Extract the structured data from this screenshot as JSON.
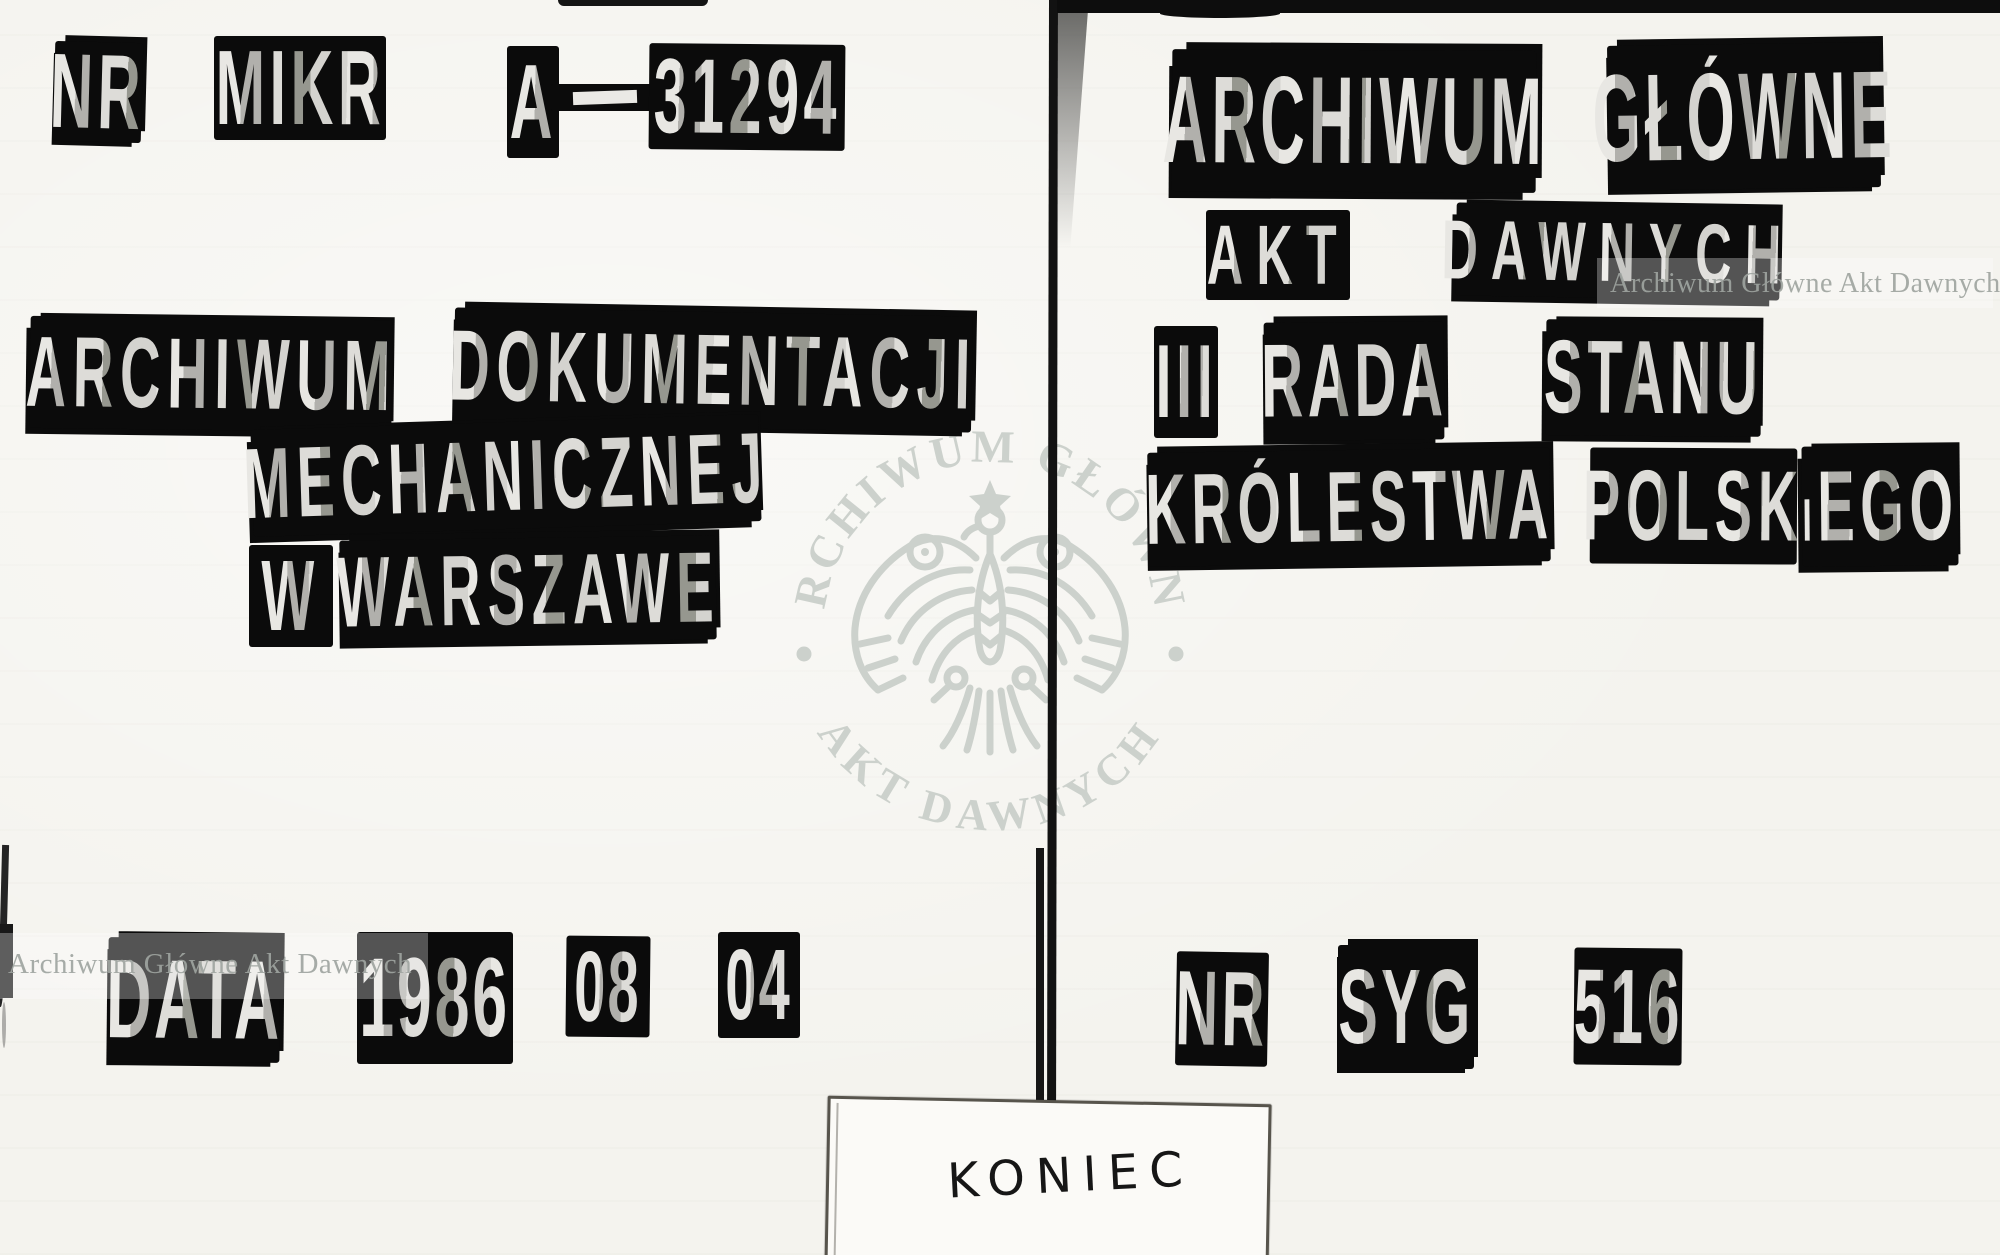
{
  "left_page": {
    "microfilm_row": {
      "nr": "NR",
      "mikr": "MIKR",
      "series": "A",
      "number": "31294"
    },
    "institution": {
      "line1_word1": "ARCHIWUM",
      "line1_word2": "DOKUMENTACJI",
      "line2": "MECHANICZNEJ",
      "line3_word1": "W",
      "line3_word2": "WARSZAWE"
    },
    "date_row": {
      "label": "DATA",
      "year": "1986",
      "month": "08",
      "day": "04"
    }
  },
  "right_page": {
    "institution": {
      "line1_word1": "ARCHIWUM",
      "line1_word2": "GŁÓWNE",
      "line2_word1": "AKT",
      "line2_word2": "DAWNYCH"
    },
    "fonds": {
      "numeral": "III",
      "word1": "RADA",
      "word2": "STANU",
      "word3": "KRÓLESTWA",
      "word4_part1": "POLSK",
      "word4_part2": "IEGO"
    },
    "signature_row": {
      "nr": "NR",
      "syg": "SYG",
      "number": "516"
    }
  },
  "watermarks": {
    "corner_text": "Archiwum Główne Akt Dawnych",
    "seal": {
      "top_text": "ARCHIWUM GŁÓWNE",
      "bottom_text": "AKT DAWNYCH",
      "eagle": "polish-eagle-emblem"
    }
  },
  "end_slip": {
    "text": "KONIEC"
  },
  "colors": {
    "paper": "#f4f3ee",
    "label_background": "#0b0b0b",
    "label_letters": "#d8d7d2",
    "watermark": "#cbd0cb",
    "slip_ink": "#161616"
  }
}
